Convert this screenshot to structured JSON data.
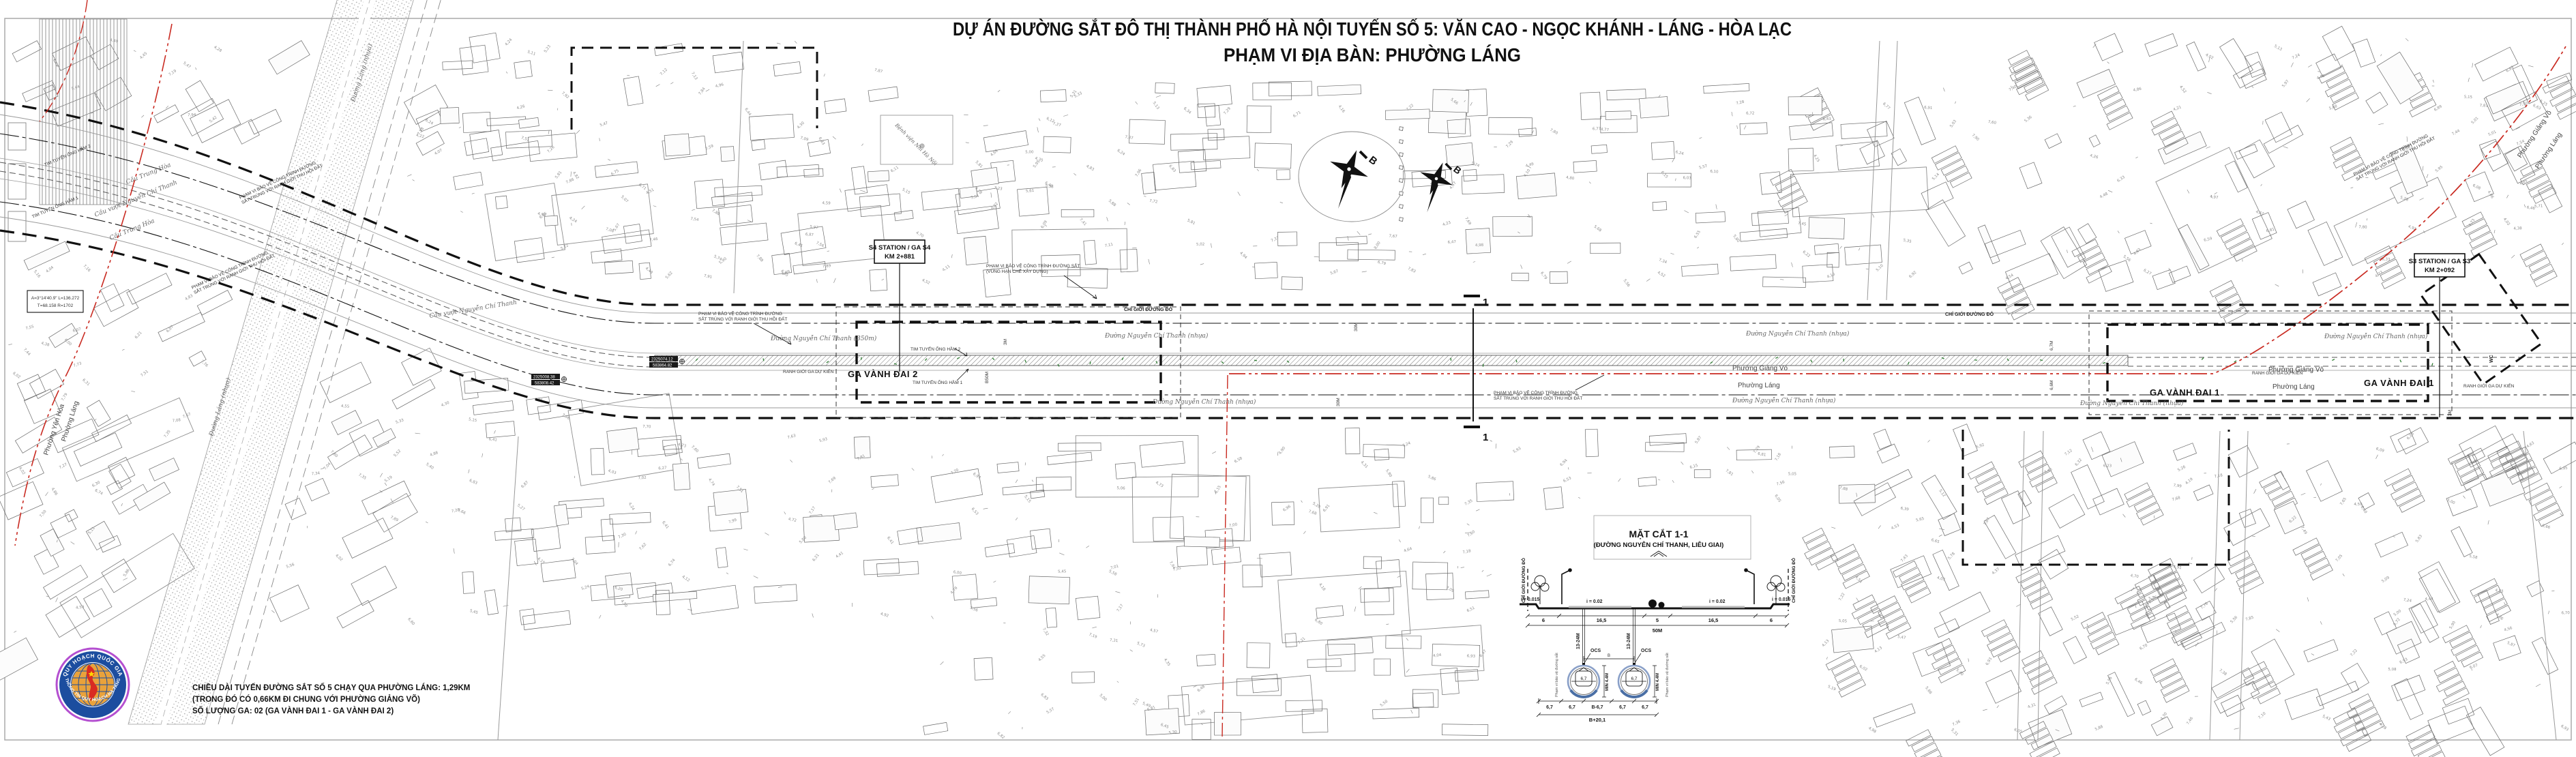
{
  "title": {
    "line1": "DỰ ÁN ĐƯỜNG SẮT ĐÔ THỊ THÀNH PHỐ HÀ NỘI TUYẾN SỐ 5: VĂN CAO - NGỌC KHÁNH - LÁNG - HÒA LẠC",
    "line2": "PHẠM VI ĐỊA BÀN: PHƯỜNG LÁNG"
  },
  "notes": {
    "line1": "CHIỀU DÀI TUYẾN ĐƯỜNG SẮT SỐ 5 CHẠY QUA PHƯỜNG LÁNG: 1,29KM",
    "line2": "(TRONG ĐÓ CÓ 0,66KM ĐI CHUNG VỚI PHƯỜNG GIẢNG VÕ)",
    "line3": "SỐ LƯỢNG GA: 02 (GA VÀNH ĐAI 1 - GA VÀNH ĐAI 2)"
  },
  "logo": {
    "arc_top": "QUY HOẠCH QUỐC GIA",
    "arc_bottom": "THÔNG TIN QUY HOẠCH-HẠ TẦNG",
    "ring_color": "#1c4d9f",
    "rim_color": "#b44fd0",
    "globe_color": "#e9a23b",
    "map_color": "#d92b22"
  },
  "compass": {
    "label": "B"
  },
  "cut": {
    "number": "1"
  },
  "stations": {
    "s4": {
      "zone": "GA VÀNH ĐAI 2",
      "callout": "S4 STATION / GA S4",
      "km": "KM 2+881"
    },
    "s3": {
      "zone": "GA VÀNH ĐAI 1",
      "callout": "S3 STATION / GA S3",
      "km": "KM 2+092"
    }
  },
  "wards": {
    "giang_vo": "Phường Giảng Võ",
    "lang": "Phường Láng",
    "yen_hoa": "Phường Yên Hòa"
  },
  "streets": {
    "nct": "Đường Nguyễn Chí Thanh (nhựa)",
    "nct_b50": "Đường Nguyễn Chí Thanh (B50m)",
    "lang": "Đường Láng (nhựa)",
    "bridge_trung_hoa": "Cầu Trung Hòa",
    "bridge_vuot_nct": "Cầu vượt Nguyễn Chí Thanh"
  },
  "poi": {
    "hospital": "Bệnh viện Nhi Hà Nội",
    "wc": "WC"
  },
  "labels": {
    "red_line": "CHỈ GIỚI ĐƯỜNG ĐỎ",
    "protect_l1": "PHẠM VI BẢO VỆ CÔNG TRÌNH ĐƯỜNG",
    "protect_l2": "SẮT TRÙNG VỚI RANH GIỚI THU HỒI ĐẤT",
    "restrict_l1": "PHẠM VI BẢO VỆ CÔNG TRÌNH ĐƯỜNG SẮT",
    "restrict_l2": "(VÙNG HẠN CHẾ XÂY DỰNG)",
    "station_boundary": "RANH GIỚI GA DỰ KIẾN",
    "tunnel2": "TIM TUYẾN ỐNG HẦM 2",
    "tunnel1": "TIM TUYẾN ỐNG HẦM 1"
  },
  "dims": {
    "d30": "30M",
    "b50": "B50M",
    "d67": "6,7M",
    "d66": "6,6M",
    "d3": "3M"
  },
  "coords": {
    "p1": {
      "n": "2325074.12",
      "e": "583864.82"
    },
    "p2": {
      "n": "2325008.38",
      "e": "583808.42"
    }
  },
  "curve": {
    "line1": "A=3°14'40.9\" L=136.272",
    "line2": "T=68.158 R=1702"
  },
  "section": {
    "title": "MẶT CẮT 1-1",
    "subtitle": "(ĐƯỜNG NGUYỄN CHÍ THANH, LIỄU GIAI)",
    "slope_side": "i = 0.015",
    "slope_road": "i = 0.02",
    "w_side": "6",
    "w_road": "16,5",
    "w_med": "5",
    "total": "50M",
    "depth": "13-24M",
    "ocs": "OCS",
    "min_clear": "MIN 4.4M",
    "d67": "6,7",
    "b": "B",
    "b_minus": "B-6,7",
    "b_plus": "B+20,1",
    "red_line": "CHỈ GIỚI ĐƯỜNG ĐỎ",
    "protect": "Phạm vi bảo vệ đường sắt"
  }
}
